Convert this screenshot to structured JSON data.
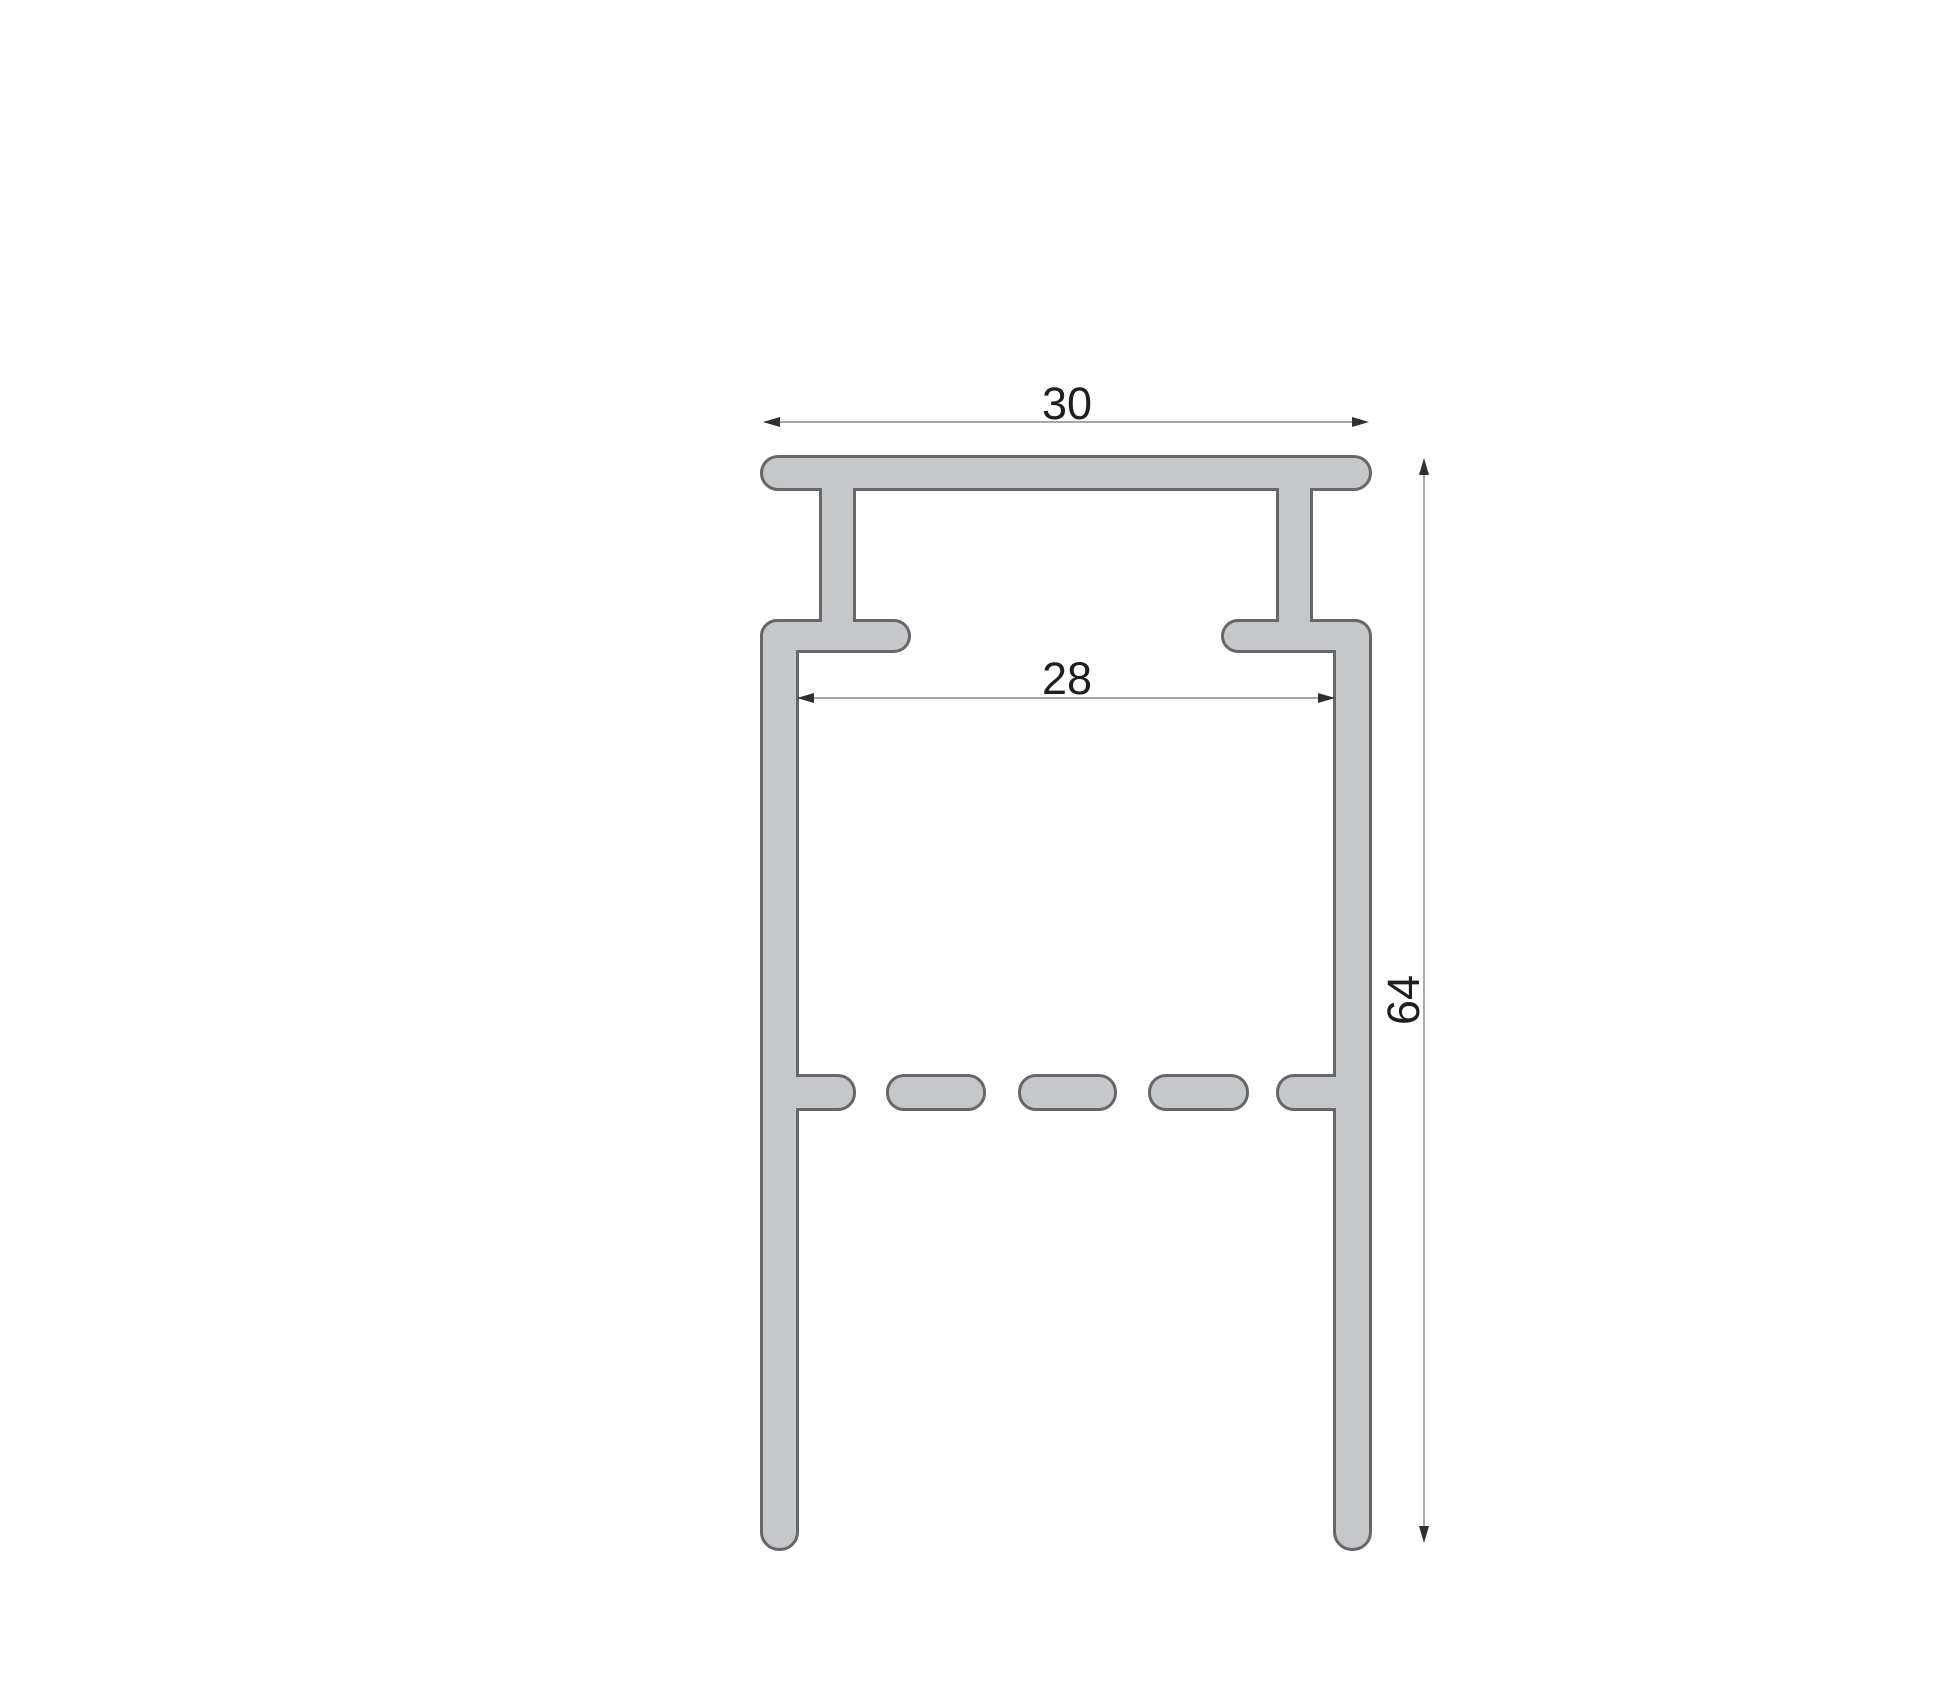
{
  "diagram": {
    "type": "profile-cross-section-drawing",
    "dimensions": {
      "top_width": "30",
      "inner_width": "28",
      "height": "64"
    },
    "colors": {
      "background": "#ffffff",
      "profile_fill": "#c6c7c9",
      "profile_stroke": "#66676a",
      "dimension_line": "#9b9b9b",
      "dimension_arrow": "#2f2f2f",
      "dimension_text": "#1e1e1e"
    }
  }
}
